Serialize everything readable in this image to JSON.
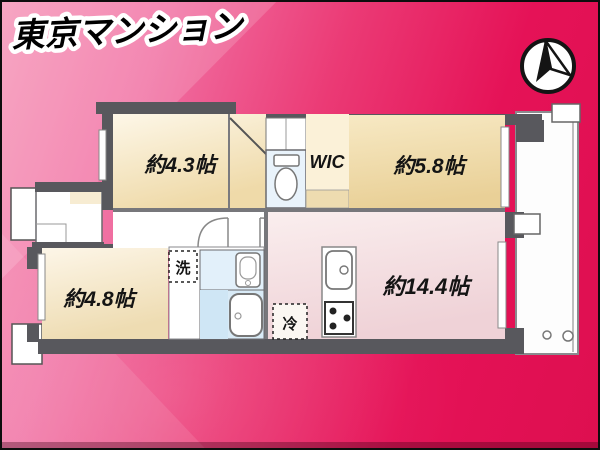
{
  "colors": {
    "background_pink": "#f695b7",
    "background_crimson": "#e51257",
    "wall_gray": "#58585d",
    "room_cream": "#f1dcae",
    "room_tan": "#ead29b",
    "ldk_pink": "#f1d4d9",
    "wet_blue": "#e2f0fa",
    "logo_fill": "#000000",
    "logo_outline": "#ffffff"
  },
  "compass": {
    "icon": "north-compass"
  },
  "floorplan": {
    "rooms": [
      {
        "name": "bedroom-1",
        "label": "約4.3帖"
      },
      {
        "name": "walk-in-closet",
        "label": "WIC"
      },
      {
        "name": "bedroom-2",
        "label": "約5.8帖"
      },
      {
        "name": "bedroom-3",
        "label": "約4.8帖"
      },
      {
        "name": "living-dining-kitchen",
        "label": "約14.4帖"
      }
    ],
    "fixtures": [
      {
        "name": "washing-machine-space",
        "label": "洗"
      },
      {
        "name": "refrigerator-space",
        "label": "冷"
      }
    ],
    "icons": [
      "toilet-icon",
      "bathtub-icon",
      "washbasin-icon",
      "kitchen-sink-icon",
      "stove-icon",
      "door-swing-icon",
      "balcony-drain-icon"
    ]
  },
  "branding": {
    "logo": "東京マンション"
  }
}
